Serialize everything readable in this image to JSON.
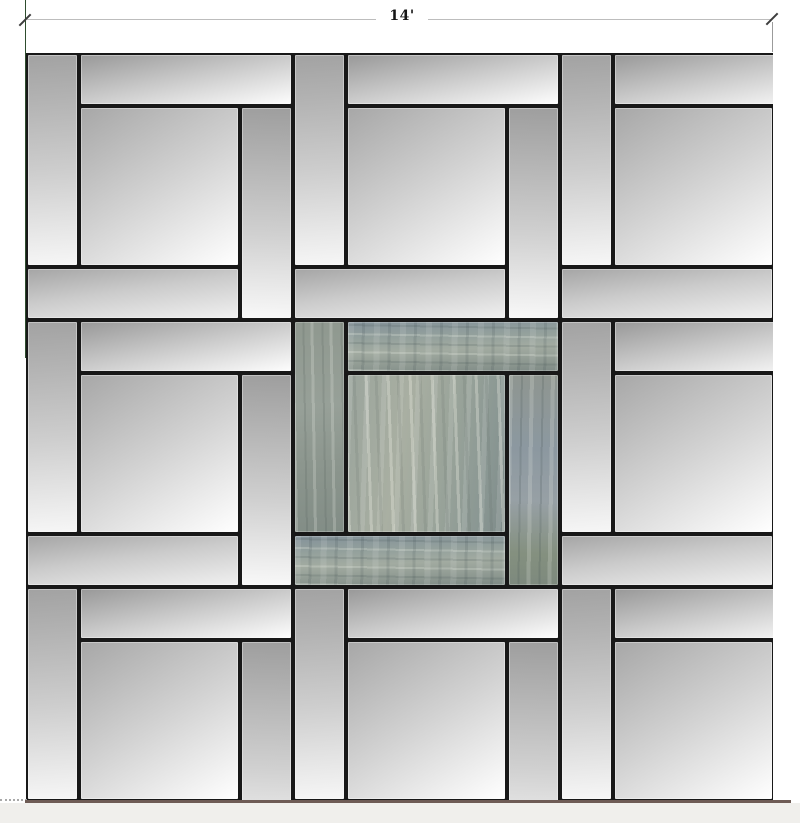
{
  "drawing": {
    "title": "paver-patio-plan",
    "dimension": {
      "label": "14'"
    },
    "pattern": {
      "name": "pinwheel-paver-grid",
      "grid": {
        "rows": 3,
        "cols": 3,
        "module_size_ft": 5,
        "field_size_ft": 14
      },
      "tile_kinds": [
        "left-plank",
        "top-plank",
        "center-square",
        "right-plank",
        "bottom-plank"
      ],
      "modules": [
        {
          "row": 0,
          "col": 0,
          "material": "silver"
        },
        {
          "row": 0,
          "col": 1,
          "material": "silver"
        },
        {
          "row": 0,
          "col": 2,
          "material": "silver"
        },
        {
          "row": 1,
          "col": 0,
          "material": "silver"
        },
        {
          "row": 1,
          "col": 1,
          "material": "slate"
        },
        {
          "row": 1,
          "col": 2,
          "material": "silver"
        },
        {
          "row": 2,
          "col": 0,
          "material": "silver"
        },
        {
          "row": 2,
          "col": 1,
          "material": "silver"
        },
        {
          "row": 2,
          "col": 2,
          "material": "silver"
        }
      ]
    },
    "colors": {
      "silver_tile_dark": "#9e9e9e",
      "silver_tile_light": "#ffffff",
      "slate_base": "#93a09c",
      "slate_light": "#a9afa2",
      "slate_dark": "#7e8b89",
      "grout": "#181818",
      "extension_line_green": "#2e4d2e",
      "dimension_line": "#bdbdbd",
      "ground_line_brown": "#6e5b55",
      "footer_strip": "#f0efec"
    }
  }
}
